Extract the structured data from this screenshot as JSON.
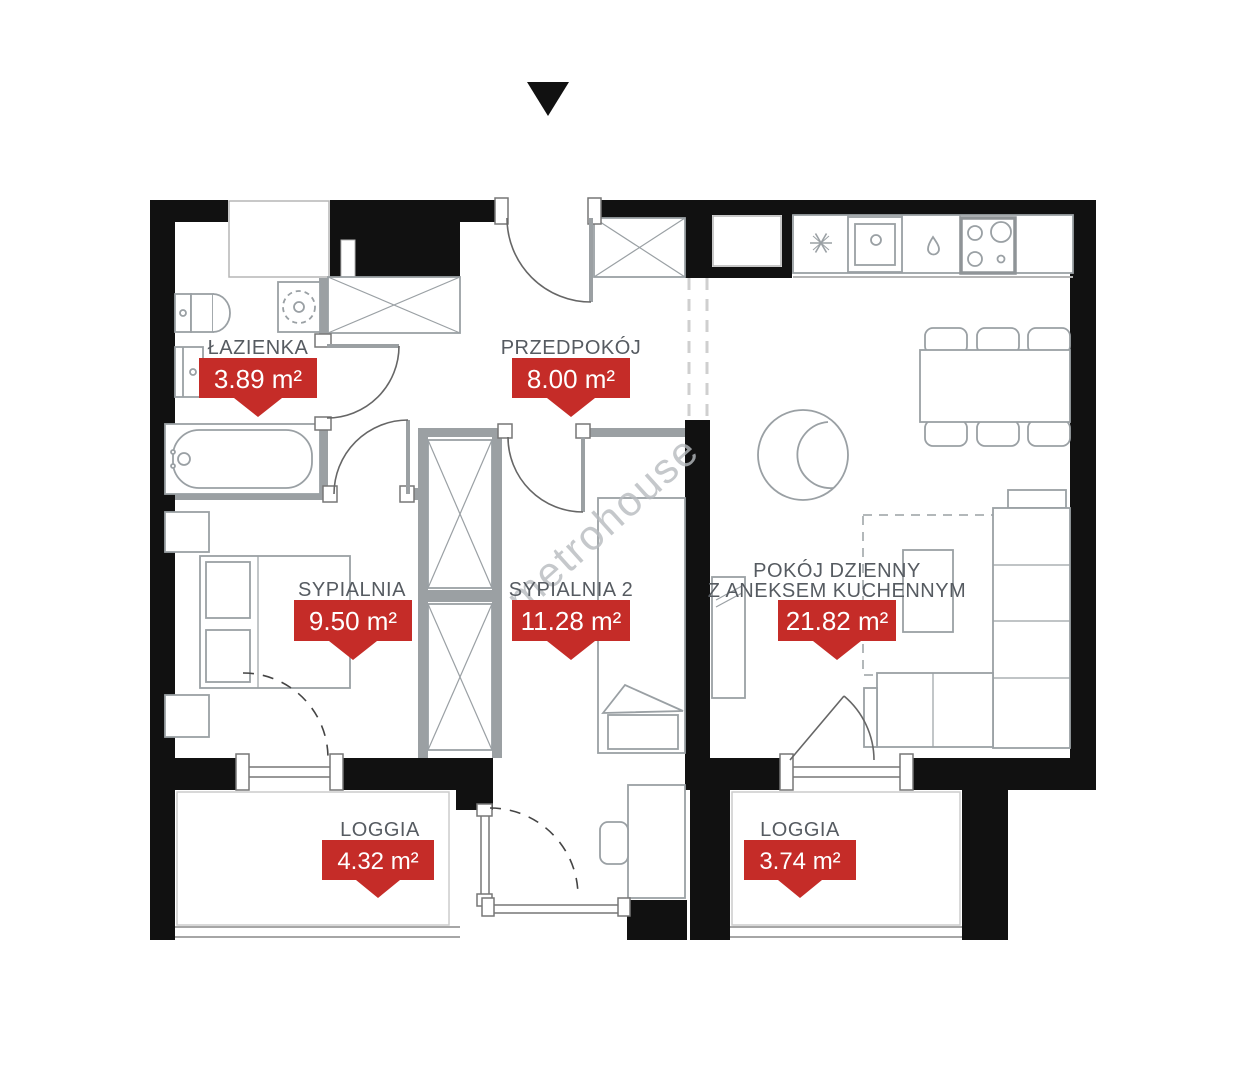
{
  "watermark": "metrohouse",
  "rooms": [
    {
      "name": "ŁAZIENKA",
      "area": "3.89 m²"
    },
    {
      "name": "PRZEDPOKÓJ",
      "area": "8.00 m²"
    },
    {
      "name": "SYPIALNIA",
      "area": "9.50 m²"
    },
    {
      "name": "SYPIALNIA 2",
      "area": "11.28 m²"
    },
    {
      "name": "POKÓJ DZIENNY",
      "name2": "Z ANEKSEM KUCHENNYM",
      "area": "21.82 m²"
    },
    {
      "name": "LOGGIA",
      "area": "4.32 m²"
    },
    {
      "name": "LOGGIA",
      "area": "3.74 m²"
    }
  ],
  "colors": {
    "badge": "#c52c28",
    "badge_text": "#ffffff",
    "room_label": "#565b61",
    "wall": "#111111",
    "partition": "#9ba0a3",
    "watermark": "#b7bbbf"
  }
}
